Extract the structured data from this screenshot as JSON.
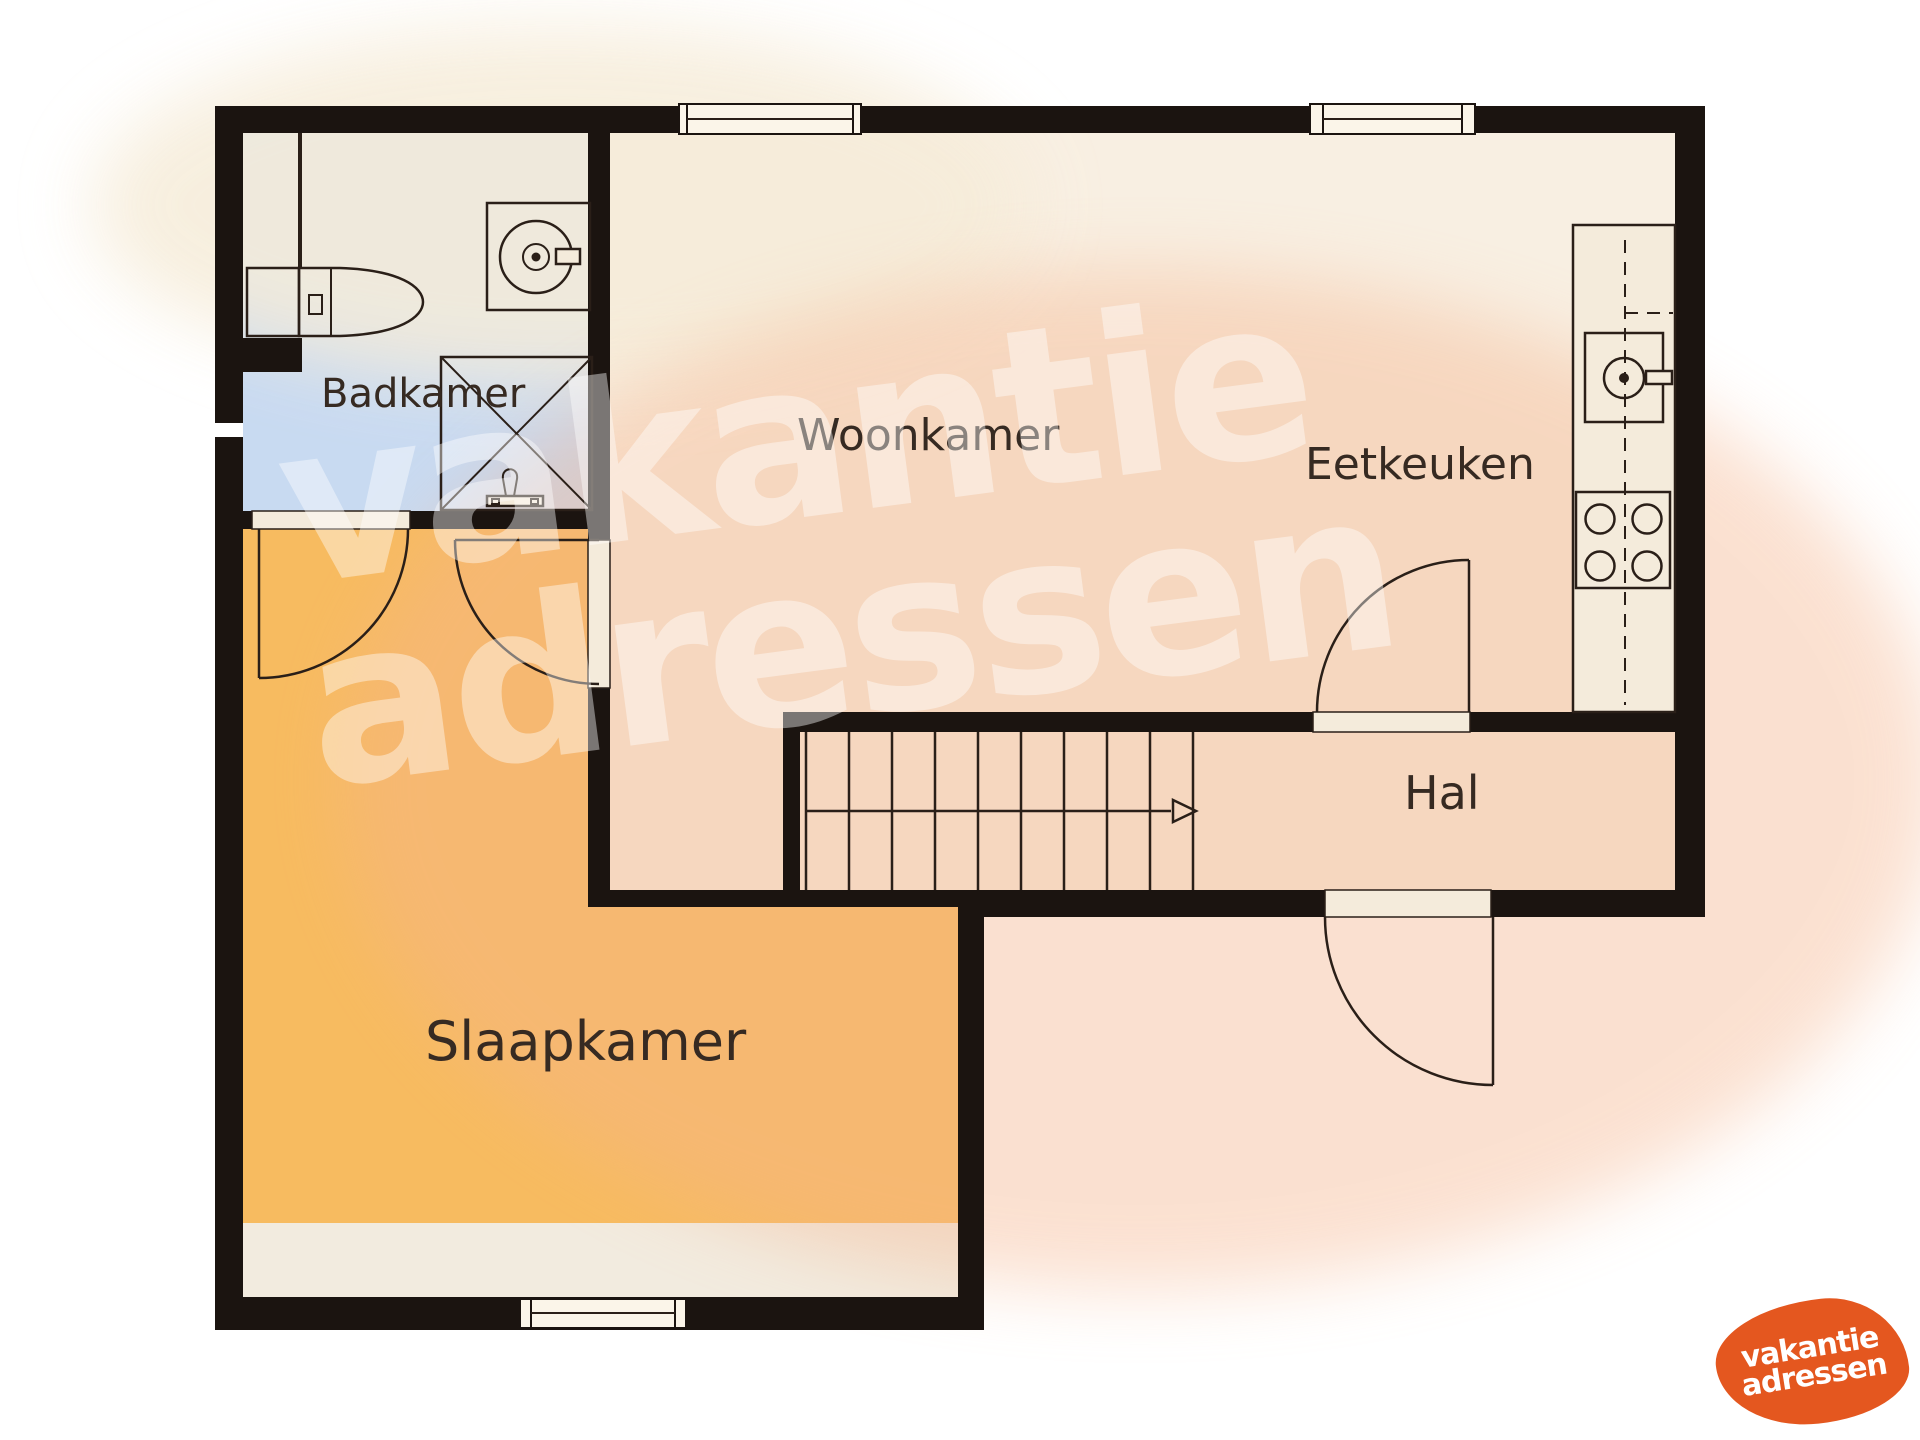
{
  "document": {
    "type": "floor-plan",
    "language": "nl",
    "description": "Single floor plan drawing on white background with watermark and brand logo"
  },
  "rooms": {
    "badkamer": {
      "label": "Badkamer",
      "floor_color": "#c8daf1"
    },
    "woonkamer": {
      "label": "Woonkamer",
      "floor_color": "#f8efe2"
    },
    "eetkeuken": {
      "label": "Eetkeuken",
      "floor_color": "#f8efe2"
    },
    "hal": {
      "label": "Hal",
      "floor_color": "#f8efe2"
    },
    "slaapkamer": {
      "label": "Slaapkamer",
      "floor_color": "#f7bb60"
    }
  },
  "fixtures": {
    "toilet": "toilet-icon",
    "shower": "shower-icon",
    "washing_machine": "washing-machine-icon",
    "oven": "oven-icon",
    "stove": "stove-burners-icon",
    "staircase": "stairs-with-direction-arrow",
    "doors": "quarter-circle-door-swings",
    "windows": "double-line-window-symbols"
  },
  "watermark": {
    "line1": "vakantie",
    "line2": "adressen",
    "color": "rgba(255,255,255,0.42)"
  },
  "logo": {
    "line1": "vakantie",
    "line2": "adressen",
    "background_color": "#e4571f",
    "text_color": "#ffffff"
  },
  "colors": {
    "wall": "#1b1410",
    "outline": "#2a1f18",
    "floor_cream": "#f8efe2",
    "floor_blue": "#c8daf1",
    "floor_orange": "#f7bb60",
    "floor_strip": "#f2ebdf",
    "label_text": "#362a22",
    "watermark_blob_pink": "#f5b48c",
    "background": "#ffffff"
  }
}
